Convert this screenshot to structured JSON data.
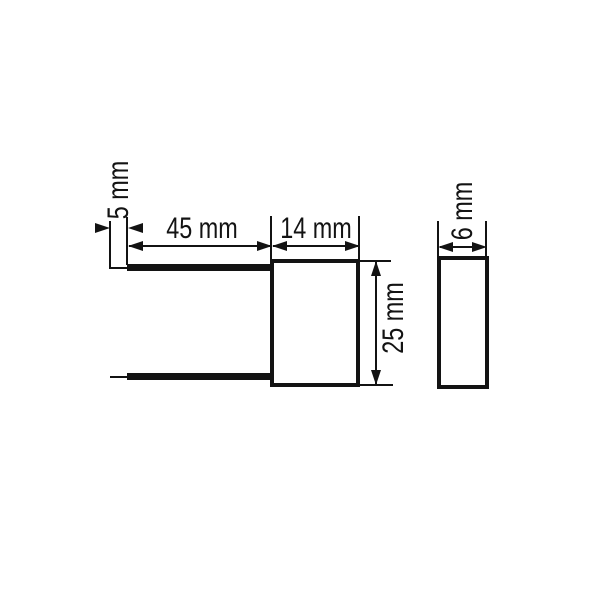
{
  "drawing": {
    "type": "component-dimension-drawing",
    "background": "#ffffff",
    "line_color": "#131313",
    "views": [
      {
        "id": "front",
        "description": "front view: rectangular body with two wire leads to the left"
      },
      {
        "id": "side",
        "description": "side view: narrow rectangular body profile"
      }
    ],
    "dimensions": {
      "lead_tip": "5 mm",
      "lead_length": "45 mm",
      "body_width": "14 mm",
      "body_height": "25 mm",
      "body_depth": "6 mm"
    }
  }
}
